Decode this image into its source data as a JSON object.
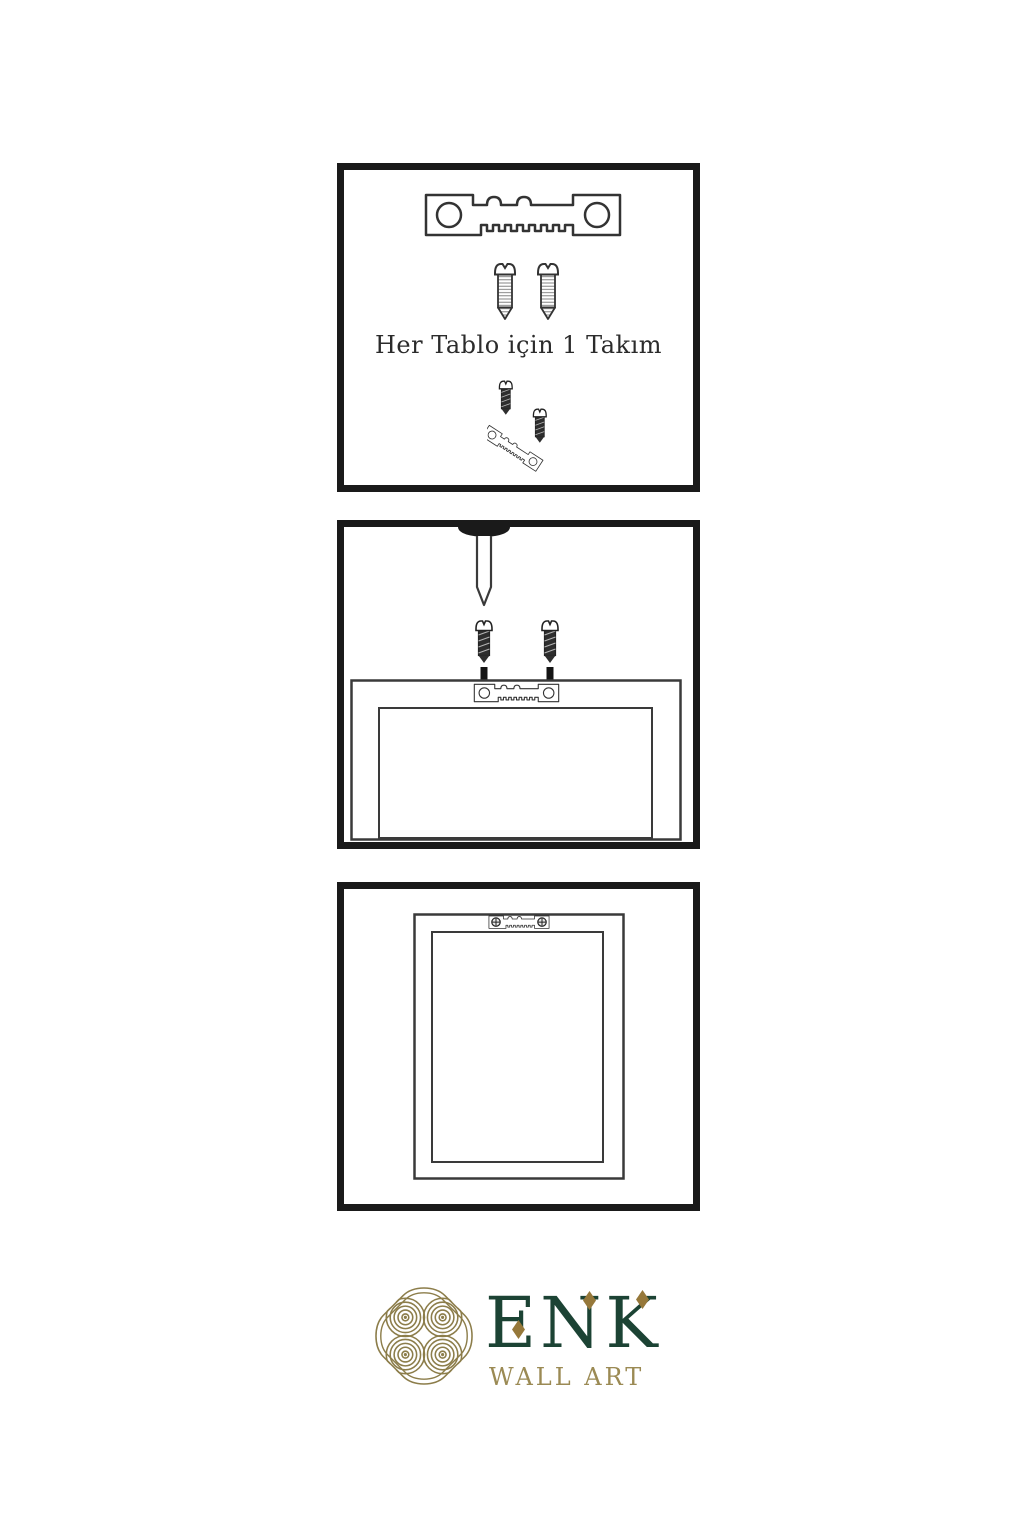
{
  "colors": {
    "panel_border": "#1a1a1a",
    "line": "#3a3a3a",
    "dark_fill": "#1c1c1c",
    "brand_green": "#1c4334",
    "brand_gold": "#9b8a54",
    "knot_gold": "#8c7d4a",
    "diamond_gold": "#96783a"
  },
  "steps": [
    {
      "label": "Her Tablo için 1 Takım",
      "icons": [
        "sawtooth-hanger-icon",
        "screw-icon",
        "screw-icon",
        "angled-hanger-with-screws-icon"
      ]
    },
    {
      "icons": [
        "screwdriver-icon",
        "screw-icon",
        "screw-icon",
        "down-arrow-icon",
        "down-arrow-icon",
        "frame-back-with-hanger-icon"
      ]
    },
    {
      "icons": [
        "frame-back-with-mounted-hanger-icon"
      ]
    }
  ],
  "brand": {
    "name": "ENK",
    "tagline": "WALL ART"
  }
}
